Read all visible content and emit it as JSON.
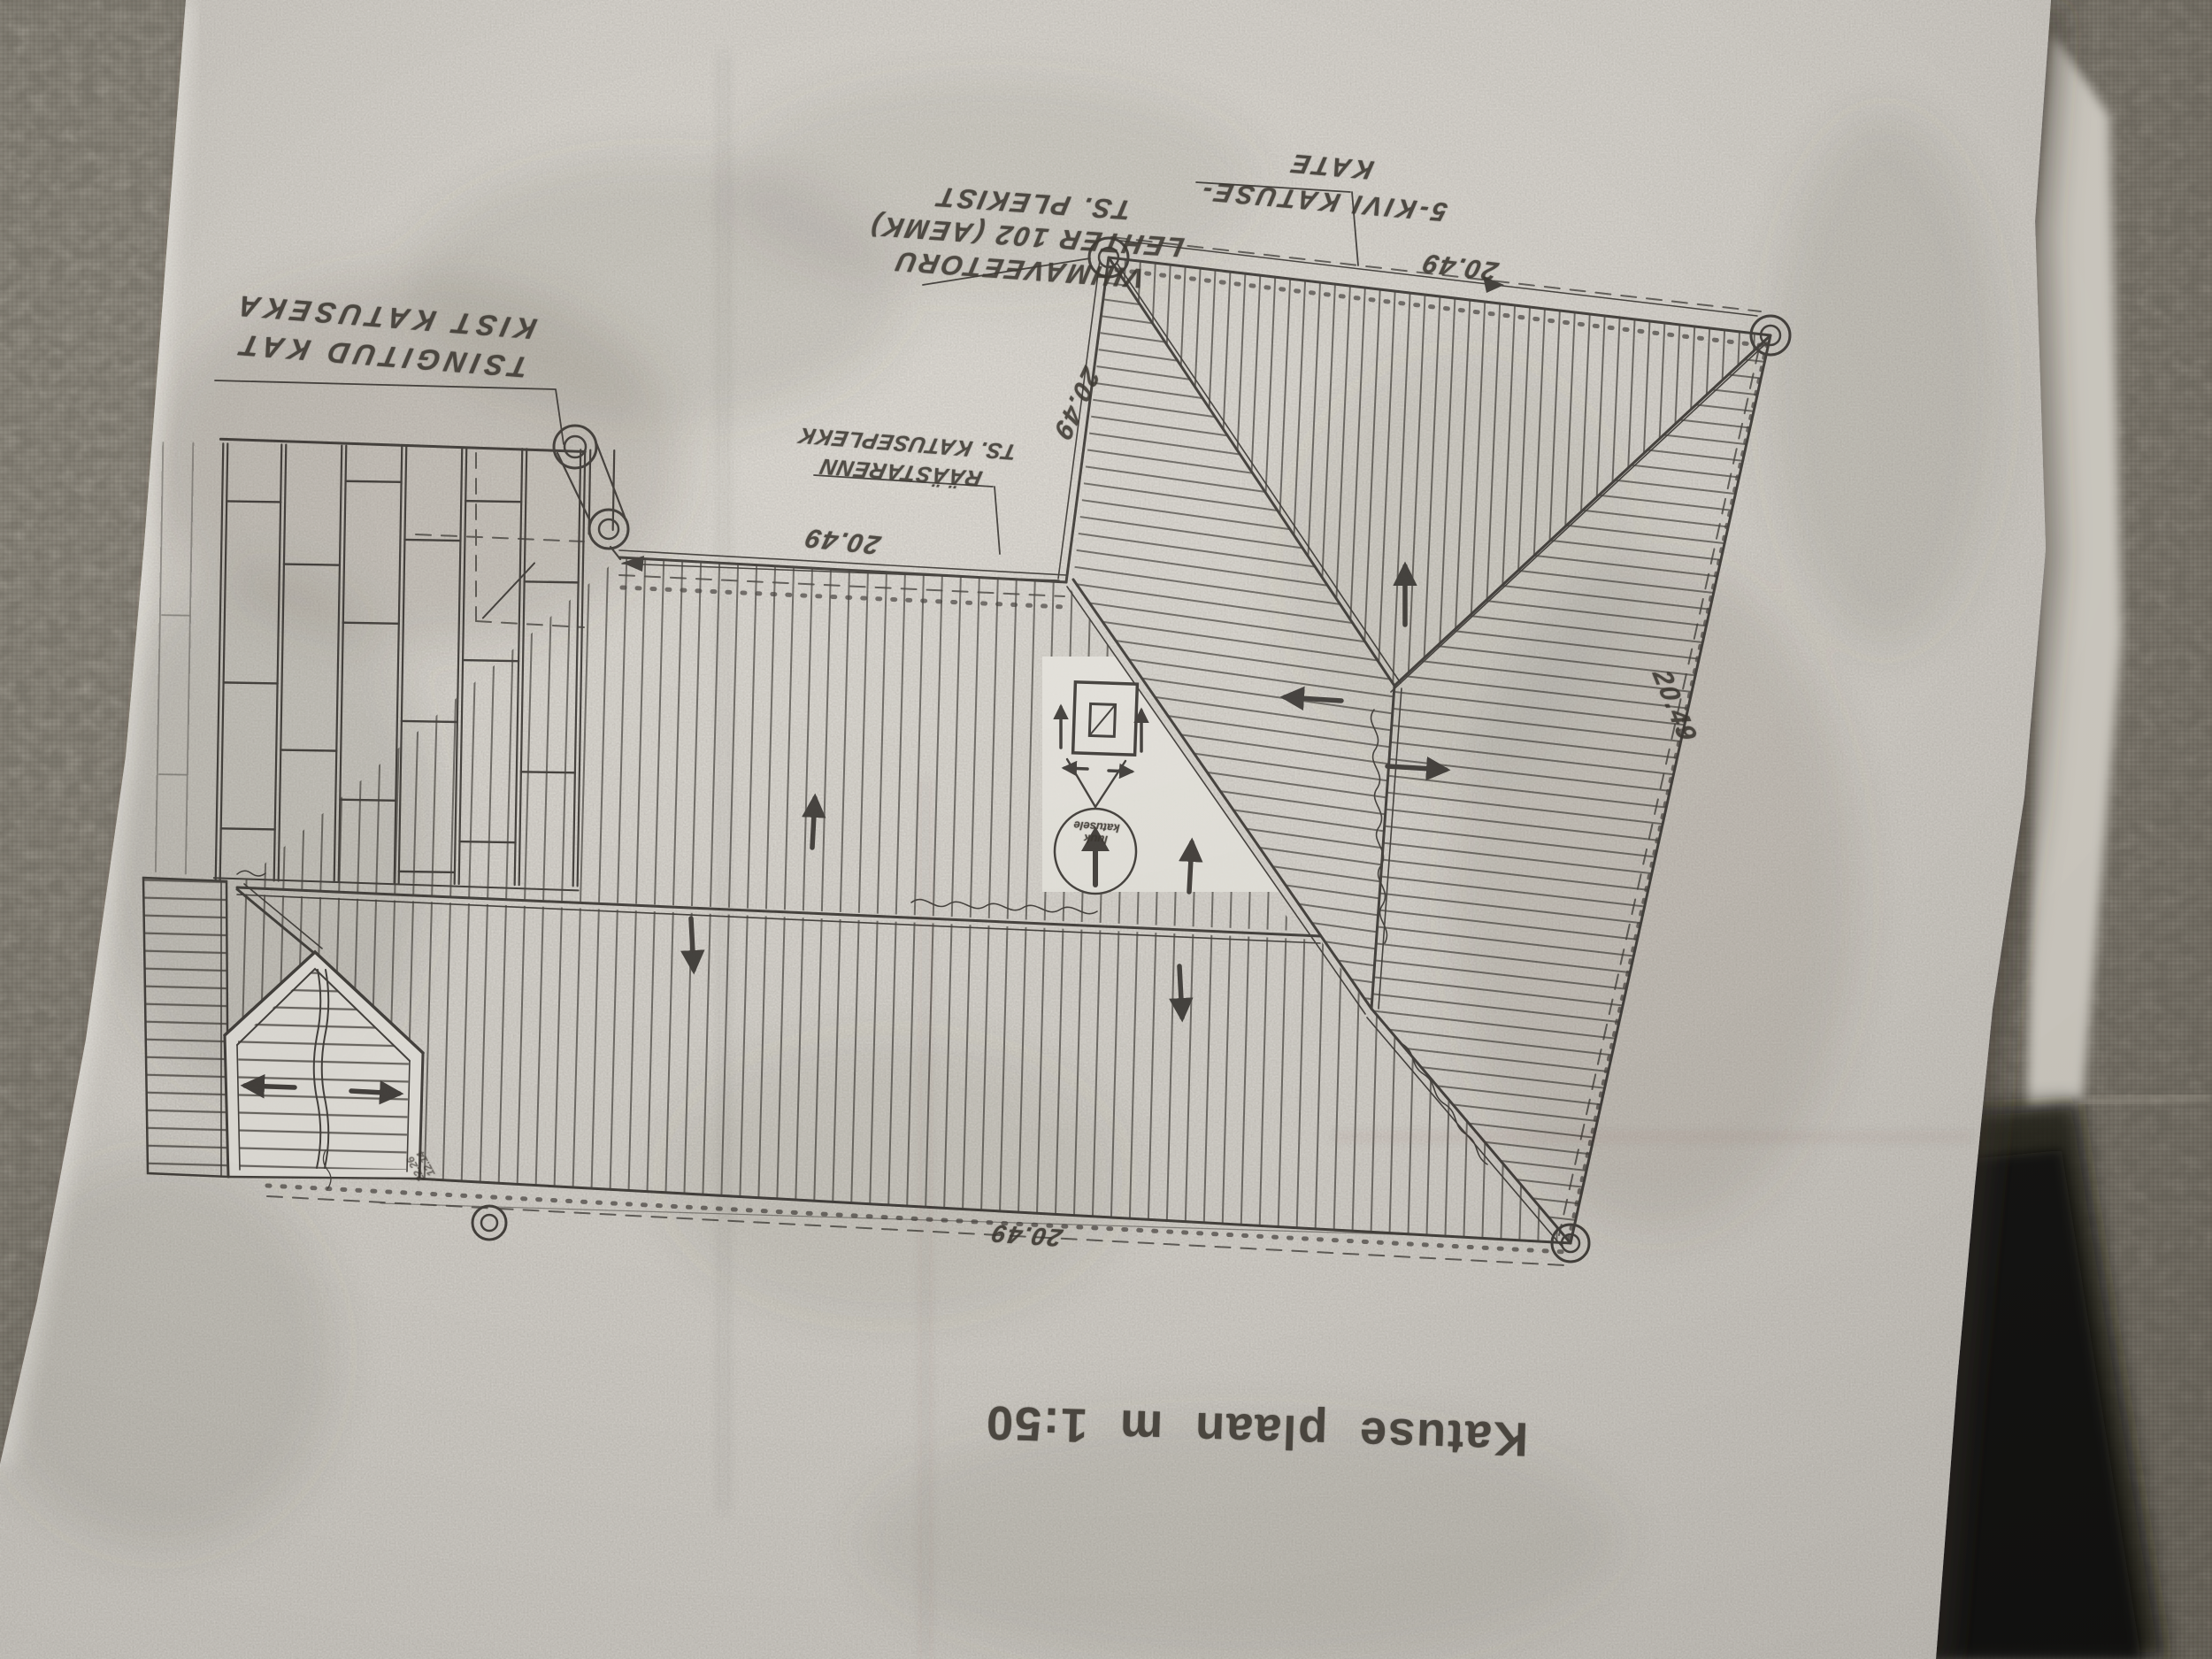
{
  "scene": {
    "subject": "photocopied roof plan lying upside-down on woven fabric",
    "fabric_color": "#a29c90",
    "paper_color": "#e9e6e0",
    "ink_color": "#2d2a26"
  },
  "drawing": {
    "title": "Katuse plaan m 1:50",
    "labels": [
      {
        "id": "tsingitud",
        "lines": [
          "TSINGITUD KAT",
          "KIST KATUSEKA"
        ]
      },
      {
        "id": "raastarenn",
        "lines": [
          "RÄÄSTARENN",
          "TS. KATUSEPLEKK"
        ]
      },
      {
        "id": "vihmaveetoru",
        "lines": [
          "VIHMAVEETORU",
          "LEHTER 102 (AEMK)",
          "TS. PLEKIST"
        ]
      },
      {
        "id": "kivi",
        "lines": [
          "5-KIVI KATUSE-",
          "KATE"
        ]
      }
    ],
    "dimensions": {
      "top": "20.49",
      "left": "20.49",
      "middle": "20.49",
      "right": "20.49",
      "bottom": "20.49"
    },
    "stamp_lines": [
      "luuk",
      "katusele"
    ],
    "small_numbers": [
      "22.26",
      "12.14"
    ]
  }
}
